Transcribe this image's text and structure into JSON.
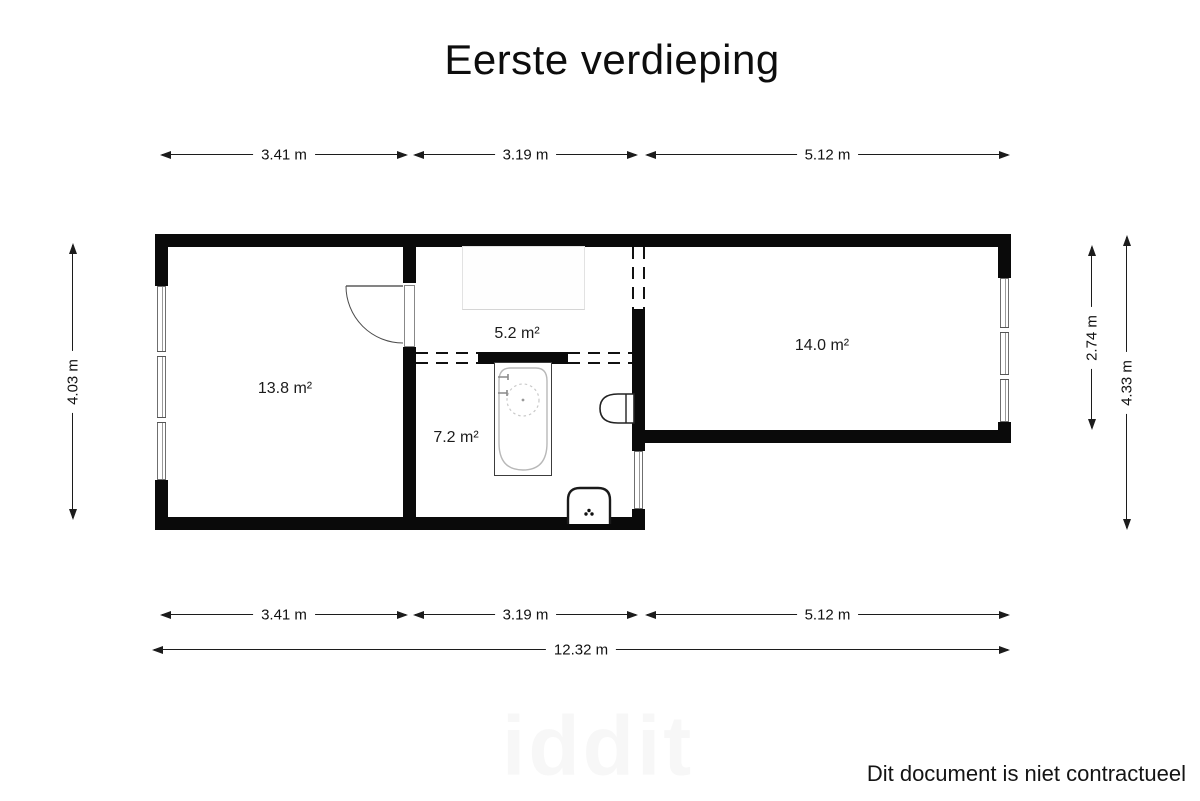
{
  "title": "Eerste verdieping",
  "floorplan": {
    "rooms": [
      {
        "name": "room-left",
        "area": "13.8 m²"
      },
      {
        "name": "room-middle",
        "area": "5.2 m²"
      },
      {
        "name": "bathroom",
        "area": "7.2 m²"
      },
      {
        "name": "room-right",
        "area": "14.0 m²"
      }
    ],
    "fixtures": [
      "door",
      "bathtub",
      "toilet",
      "sink"
    ],
    "colors": {
      "wall": "#0a0a0a",
      "line": "#1c1c1c",
      "glazing": "#6f6f6f"
    }
  },
  "dimensions": {
    "top": [
      {
        "label": "3.41 m"
      },
      {
        "label": "3.19 m"
      },
      {
        "label": "5.12 m"
      }
    ],
    "bottom": [
      {
        "label": "3.41 m"
      },
      {
        "label": "3.19 m"
      },
      {
        "label": "5.12 m"
      }
    ],
    "total_width": "12.32 m",
    "left_height": "4.03 m",
    "right_inner_height": "2.74 m",
    "right_outer_height": "4.33 m"
  },
  "footer": {
    "disclaimer": "Dit document is niet contractueel",
    "watermark": "iddit"
  }
}
